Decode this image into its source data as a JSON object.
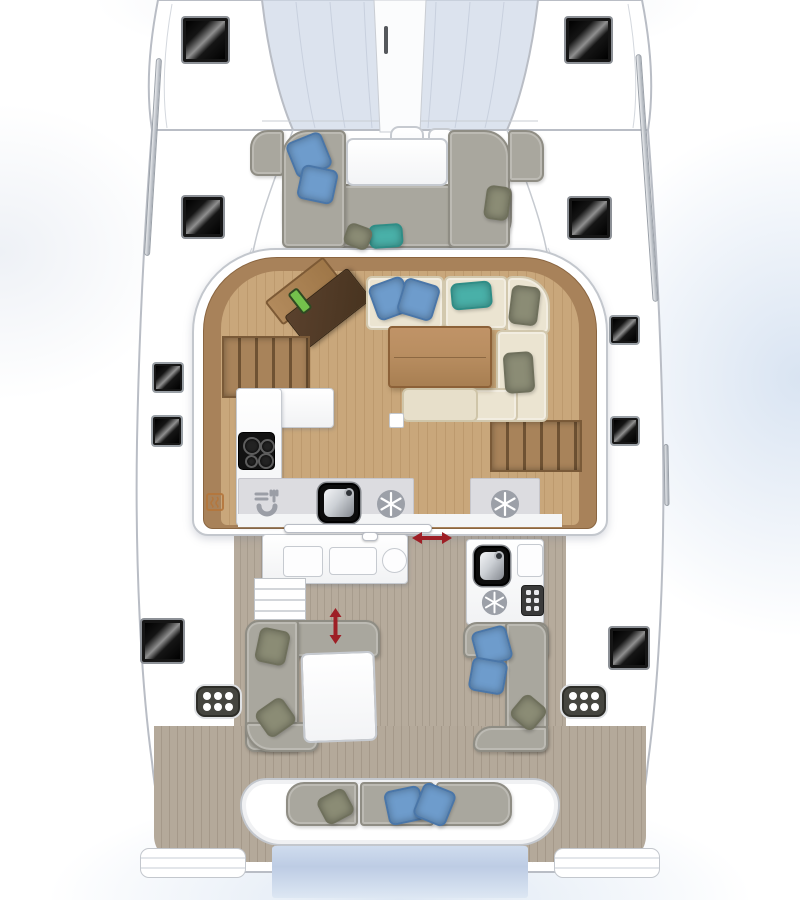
{
  "document": {
    "title": "Catamaran deck and interior layout plan",
    "type": "yacht floor plan",
    "orientation": "bow at top, stern at bottom"
  },
  "theme": {
    "hullLine": "#b9bdc5",
    "deck": "#ffffff",
    "tramp": "#dce3ee",
    "teak": "#c9a77b",
    "teakStripe": "#bd9a6e",
    "woodRim": "#a8825a",
    "woodDark": "#8a6540",
    "cream": "#ebe4d1",
    "creamEdge": "#d2c8ae",
    "blue": "#6e9ccc",
    "blueEdge": "#4a76a8",
    "teal": "#49b0a8",
    "tealEdge": "#2f8d86",
    "olive": "#8b8c75",
    "oliveEdge": "#6f705c",
    "greySofa": "#a9a79e",
    "greySofaEdge": "#8f8d84",
    "counterEdge": "#c6cad0",
    "strip": "#dcdce0",
    "stripEdge": "#c6c6cc",
    "cockpitTeak": "#b6ab9c",
    "cockpitStripe": "#a79c8d",
    "sternTeak": "#b4a99a",
    "sternStripe": "#a5998a",
    "red": "#9e1f26",
    "water": "#c2d1e8"
  },
  "areas": {
    "trampoline": "Bow trampoline",
    "bowsprit": "Bowsprit",
    "anchor_locker": "Anchor locker",
    "bow_lounge": "Forward cockpit lounge",
    "fwd_table": "Forward cockpit table",
    "saloon": "Saloon",
    "nav_station": "Chart table / nav station",
    "saloon_lounge": "Saloon lounge",
    "saloon_table": "Saloon table",
    "galley": "Galley",
    "port_steps": "Steps down to port hull",
    "stb_steps": "Steps down to starboard hull",
    "sliding_door": "Sliding door to cockpit",
    "cockpit": "Aft cockpit",
    "cockpit_galley": "Cockpit counter",
    "cockpit_steps": "Transom steps",
    "wet_bar": "Cockpit wet bar",
    "cockpit_table": "Cockpit table",
    "port_lounge": "Port cockpit lounge",
    "stb_lounge": "Starboard cockpit lounge",
    "aft_bench": "Aft bench seat",
    "swim_platform": "Swim platform / water",
    "transom_port": "Port transom step",
    "transom_stb": "Starboard transom step"
  },
  "icons": {
    "snowflake": "refrigerator / freezer",
    "sink": "sink basin",
    "cooktop": "4-burner cooktop",
    "dishes": "dish locker",
    "heater": "heater outlet",
    "grille": "engine vent grille",
    "arrow_h": "sliding door travel direction",
    "arrow_v": "convertible table travel direction",
    "deck_hatch": "deck hatch",
    "hull_window": "hull window"
  },
  "counts": {
    "deck_hatches_large": 6,
    "hull_windows_small": 4,
    "refrigerator_icons": 3,
    "sinks": 2,
    "stove_burners": 4,
    "vent_grilles": 2,
    "pillows_blue": 8,
    "pillows_teal": 2,
    "pillows_olive": 8
  }
}
